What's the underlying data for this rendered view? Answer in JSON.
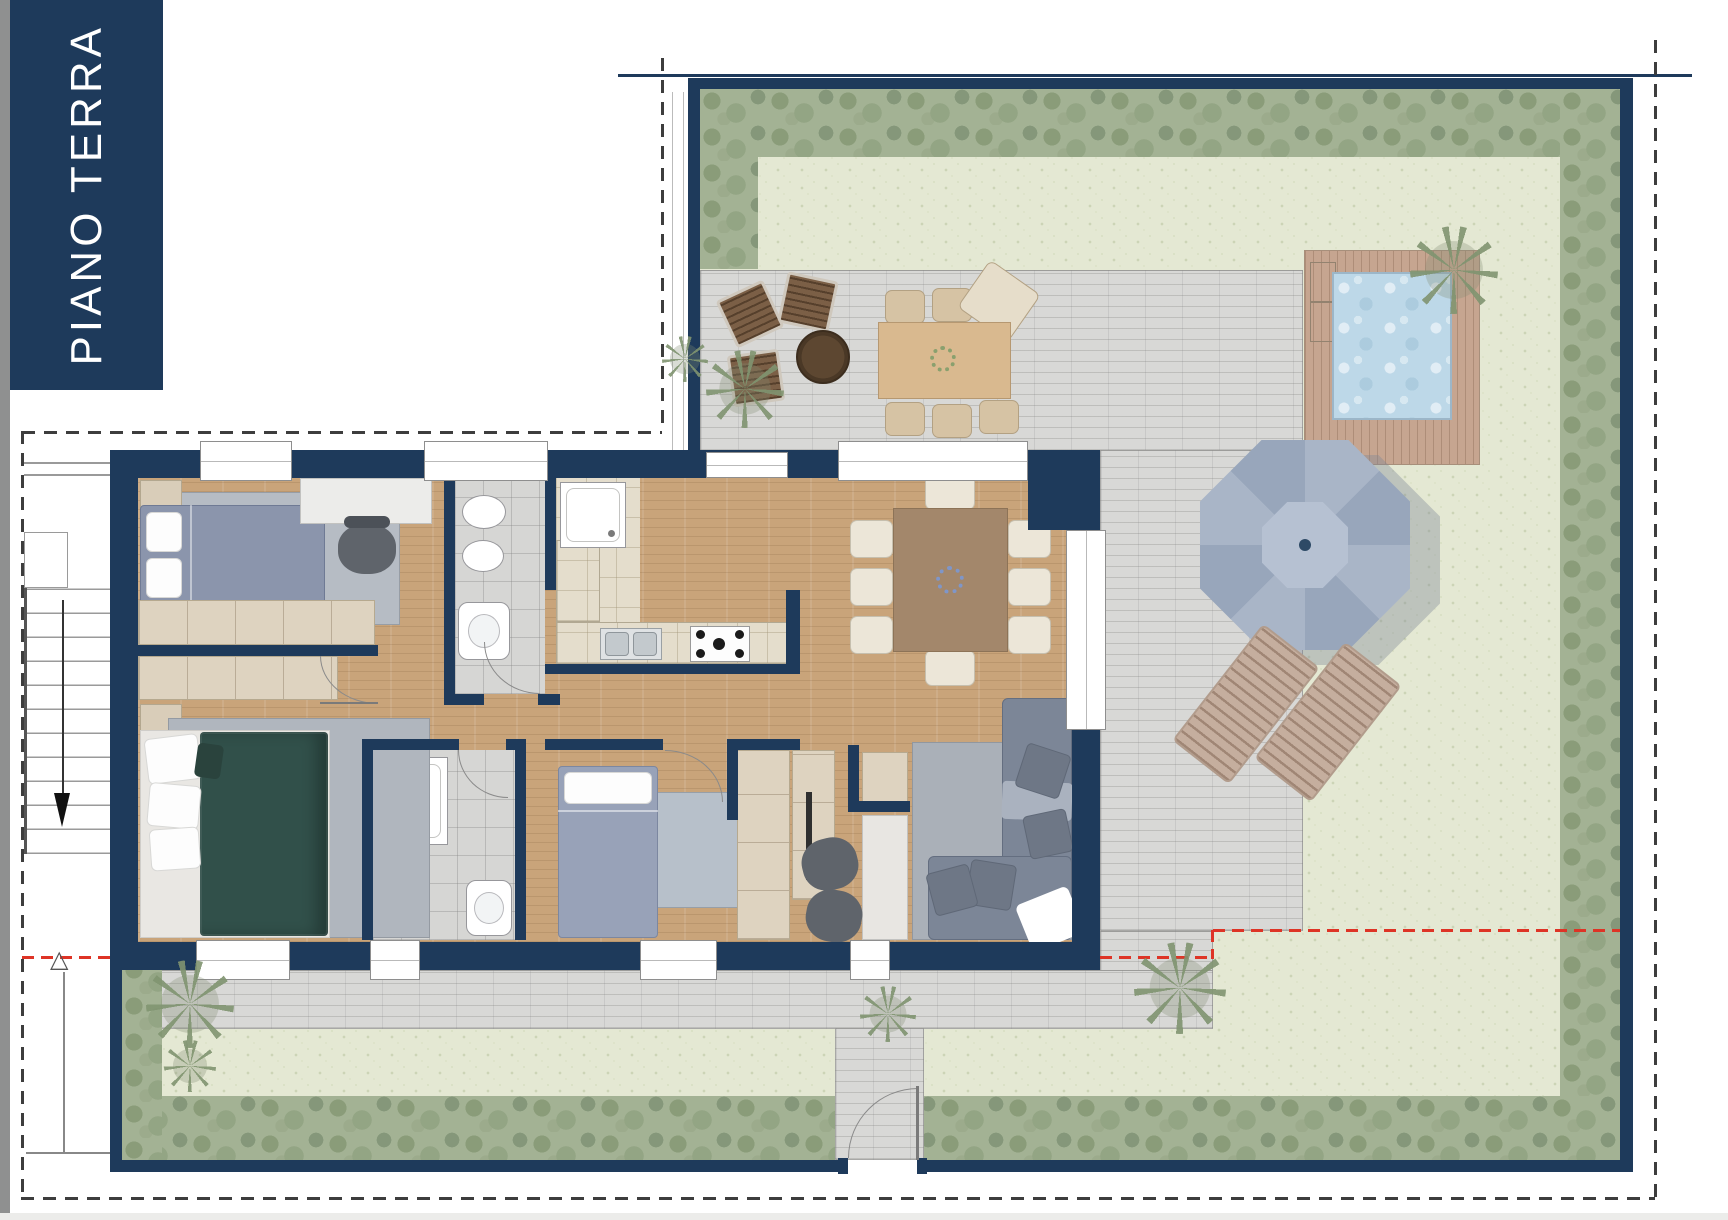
{
  "page": {
    "title_block": {
      "label": "PIANO TERRA"
    }
  },
  "plan": {
    "type": "residential-floor-plan",
    "floor": "PIANO TERRA"
  },
  "palette": {
    "wall_navy": "#1e3a5b",
    "wood_floor": "#c9a47a",
    "paving_gray": "#d8d8d6",
    "grass_green": "#e4e8d3",
    "hedge_green": "#a3b294",
    "pool_water": "#bdd8e8",
    "pool_deck": "#c6a590",
    "section_line_red": "#de3426",
    "boundary_dash": "#3d3d3d"
  }
}
